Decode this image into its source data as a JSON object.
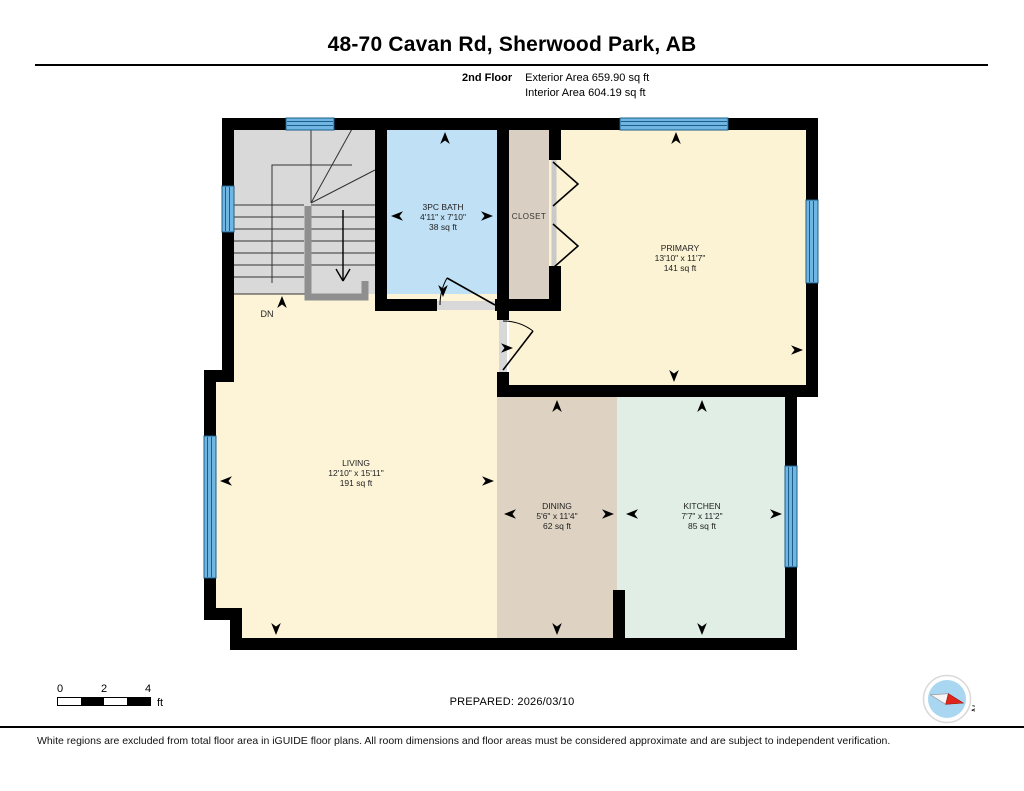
{
  "header": {
    "title": "48-70 Cavan Rd, Sherwood Park, AB",
    "floor_label": "2nd Floor",
    "exterior_area": "Exterior Area 659.90 sq ft",
    "interior_area": "Interior Area 604.19 sq ft"
  },
  "rooms": {
    "bath": {
      "name": "3PC BATH",
      "dimensions": "4'11\" x 7'10\"",
      "area": "38 sq ft"
    },
    "closet": {
      "name": "CLOSET"
    },
    "primary": {
      "name": "PRIMARY",
      "dimensions": "13'10\" x 11'7\"",
      "area": "141 sq ft"
    },
    "living": {
      "name": "LIVING",
      "dimensions": "12'10\" x 15'11\"",
      "area": "191 sq ft"
    },
    "dining": {
      "name": "DINING",
      "dimensions": "5'6\" x 11'4\"",
      "area": "62 sq ft"
    },
    "kitchen": {
      "name": "KITCHEN",
      "dimensions": "7'7\" x 11'2\"",
      "area": "85 sq ft"
    }
  },
  "stairs": {
    "direction_label": "DN"
  },
  "scale_bar": {
    "ticks": [
      "0",
      "2",
      "4"
    ],
    "unit": "ft"
  },
  "prepared_label": "PREPARED: 2026/03/10",
  "compass": {
    "north_label": "N"
  },
  "footer": {
    "disclaimer": "White regions are excluded from total floor area in iGUIDE floor plans. All room dimensions and floor areas must be considered approximate and are subject to independent verification."
  },
  "colors": {
    "wall": "#000000",
    "stairs_fill": "#d9d9d9",
    "stairs_rail": "#8f8f8f",
    "bath_fill": "#bfe0f5",
    "closet_fill": "#d9cfc2",
    "primary_fill": "#fcf2d4",
    "living_fill": "#fdf4d8",
    "dining_fill": "#ded3c2",
    "kitchen_fill": "#e0eee6",
    "window_fill": "#6fb6e3",
    "window_line": "#1d5d8a",
    "compass_north": "#e0251b"
  }
}
